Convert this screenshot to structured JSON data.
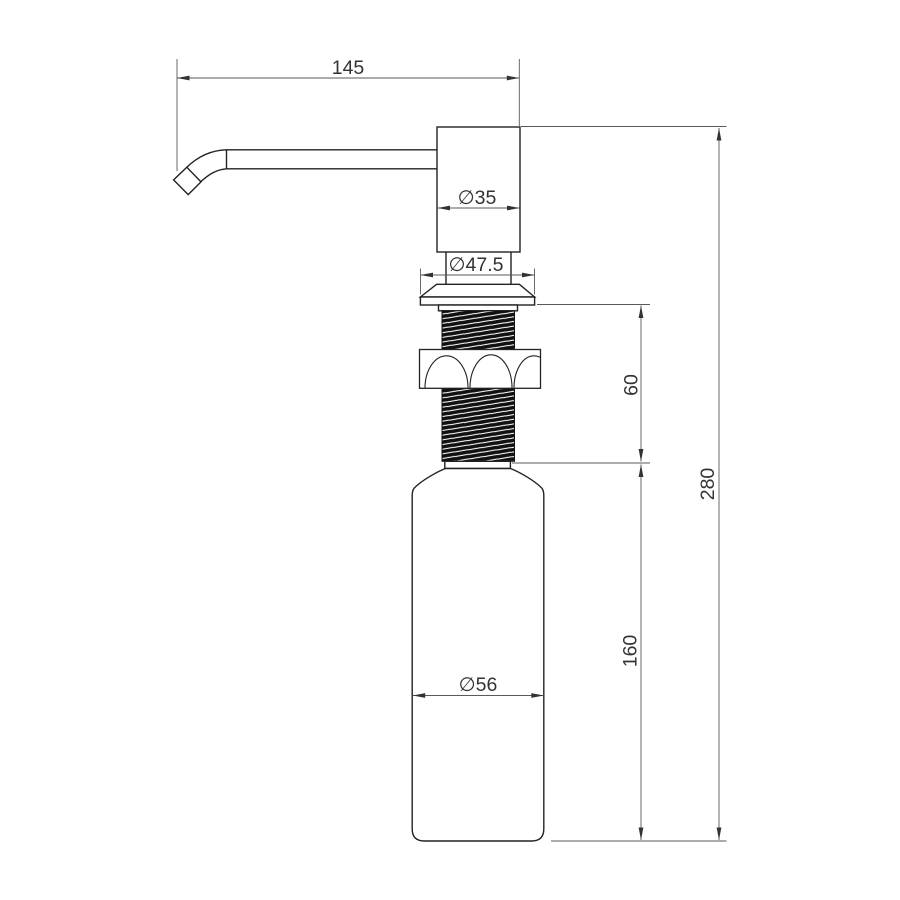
{
  "drawing": {
    "background": "#ffffff",
    "colors": {
      "outline": "#222222",
      "dimension_lines": "#5a5a5a",
      "text": "#333333",
      "thread_fill": "#111111"
    },
    "dimensions": {
      "spout_reach": {
        "label": "145"
      },
      "head_diameter": {
        "label": "∅35"
      },
      "flange_diameter": {
        "label": "∅47.5"
      },
      "thread_section_height": {
        "label": "60"
      },
      "overall_height": {
        "label": "280"
      },
      "bottle_height": {
        "label": "160"
      },
      "bottle_diameter": {
        "label": "∅56"
      }
    }
  }
}
